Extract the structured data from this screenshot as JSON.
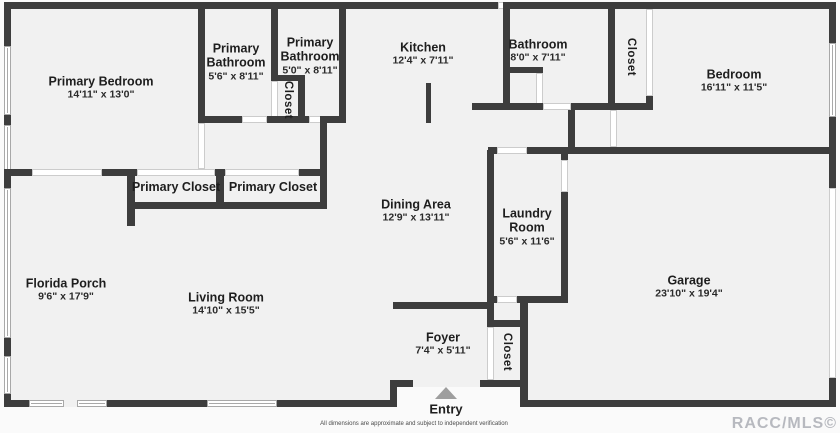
{
  "colors": {
    "wall": "#3d3d3d",
    "floor": "#f1f1f1",
    "page_background": "#fafafa",
    "entry_arrow": "#9e9e9e",
    "watermark": "#b7b9bf"
  },
  "rooms": [
    {
      "id": "primary-bedroom",
      "name": "Primary Bedroom",
      "dims": "14'11\" x 13'0\""
    },
    {
      "id": "primary-bathroom-1",
      "name": "Primary Bathroom",
      "dims": "5'6\" x 8'11\""
    },
    {
      "id": "primary-bathroom-2",
      "name": "Primary Bathroom",
      "dims": "5'0\" x 8'11\""
    },
    {
      "id": "primary-bathroom-closet",
      "name": "Closet"
    },
    {
      "id": "kitchen",
      "name": "Kitchen",
      "dims": "12'4\" x 7'11\""
    },
    {
      "id": "bathroom",
      "name": "Bathroom",
      "dims": "8'0\" x 7'11\""
    },
    {
      "id": "bedroom-closet",
      "name": "Closet"
    },
    {
      "id": "bedroom",
      "name": "Bedroom",
      "dims": "16'11\" x 11'5\""
    },
    {
      "id": "primary-closet-1",
      "name": "Primary Closet"
    },
    {
      "id": "primary-closet-2",
      "name": "Primary Closet"
    },
    {
      "id": "dining-area",
      "name": "Dining Area",
      "dims": "12'9\" x 13'11\""
    },
    {
      "id": "laundry-room",
      "name": "Laundry Room",
      "dims": "5'6\" x 11'6\""
    },
    {
      "id": "florida-porch",
      "name": "Florida Porch",
      "dims": "9'6\" x 17'9\""
    },
    {
      "id": "living-room",
      "name": "Living Room",
      "dims": "14'10\" x 15'5\""
    },
    {
      "id": "foyer",
      "name": "Foyer",
      "dims": "7'4\" x 5'11\""
    },
    {
      "id": "foyer-closet",
      "name": "Closet"
    },
    {
      "id": "garage",
      "name": "Garage",
      "dims": "23'10\" x 19'4\""
    }
  ],
  "entry": {
    "label": "Entry"
  },
  "footer": {
    "disclaimer": "All dimensions are approximate and subject to independent verification",
    "watermark": "RACC/MLS©"
  }
}
